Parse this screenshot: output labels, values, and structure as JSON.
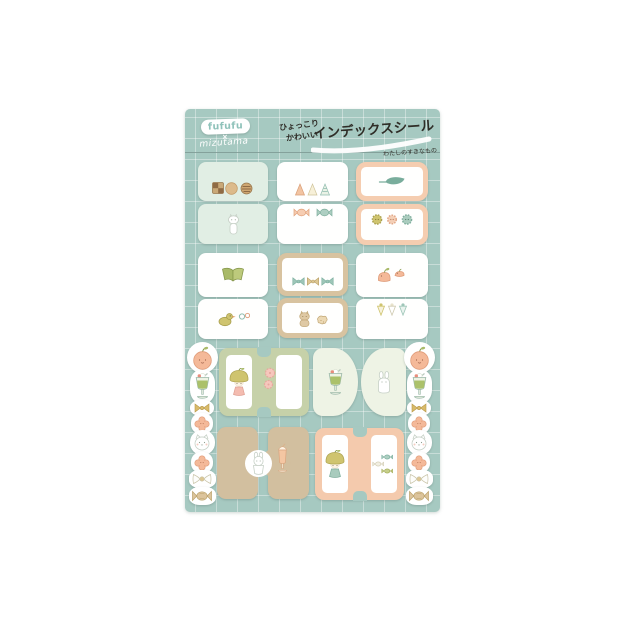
{
  "header": {
    "logo": "fufufu",
    "collab_mark": "×",
    "brand": "mizutama",
    "tagline_line1": "ひょっこり",
    "tagline_line2": "かわいい",
    "title": "インデックスシール",
    "subtitle": "わたしのすきなもの"
  },
  "palette": {
    "sheet": "#a6c9c1",
    "grid_line": "#cfe0da",
    "mint": "#e1eee4",
    "card_white": "#fffffe",
    "peach": "#f5cdb0",
    "tan": "#d8c3a0",
    "sage": "#c6d1a9",
    "mint_pale": "#eef3e5",
    "tan_solid": "#d2bf9f",
    "peach_h": "#f4caad",
    "logo_teal": "#8fc2ba",
    "ink": "#2f2d27",
    "cutline": "#7e9a94"
  },
  "stickers": {
    "tabs": [
      {
        "name": "snack-tab-mint",
        "type": "pair",
        "x": 198,
        "y": 162,
        "w": 70,
        "gap": 3,
        "halves": [
          {
            "h": 39,
            "style": "mint",
            "icon": "cookies",
            "pos": "bottom"
          },
          {
            "h": 40,
            "style": "mint",
            "icon": "cat-standing",
            "pos": "center"
          }
        ]
      },
      {
        "name": "hat-tab-white",
        "type": "pair",
        "x": 277,
        "y": 162,
        "w": 71,
        "gap": 3,
        "halves": [
          {
            "h": 39,
            "style": "white",
            "icon": "party-hats",
            "pos": "bottom"
          },
          {
            "h": 40,
            "style": "white",
            "icon": "candies",
            "pos": "top"
          }
        ]
      },
      {
        "name": "leaf-tab-peach",
        "type": "pair",
        "x": 356,
        "y": 162,
        "w": 72,
        "gap": 3,
        "halves": [
          {
            "h": 39,
            "style": "peach-frame",
            "icon": "leaf",
            "pos": "center"
          },
          {
            "h": 41,
            "style": "peach-frame",
            "icon": "buttons",
            "pos": "top"
          }
        ]
      },
      {
        "name": "book-tab-white",
        "type": "pair",
        "x": 198,
        "y": 253,
        "w": 70,
        "gap": 2,
        "halves": [
          {
            "h": 44,
            "style": "white",
            "icon": "book",
            "pos": "center"
          },
          {
            "h": 40,
            "style": "white",
            "icon": "duck-flowers",
            "pos": "center"
          }
        ]
      },
      {
        "name": "bow-tab-tan",
        "type": "pair",
        "x": 277,
        "y": 253,
        "w": 71,
        "gap": 2,
        "halves": [
          {
            "h": 43,
            "style": "tan-frame",
            "icon": "bows",
            "pos": "bottom"
          },
          {
            "h": 40,
            "style": "tan-frame",
            "icon": "cat-cookie",
            "pos": "center"
          }
        ]
      },
      {
        "name": "bird-tab-white",
        "type": "pair",
        "x": 356,
        "y": 253,
        "w": 72,
        "gap": 2,
        "halves": [
          {
            "h": 44,
            "style": "white",
            "icon": "birds",
            "pos": "center"
          },
          {
            "h": 40,
            "style": "white",
            "icon": "cones",
            "pos": "top"
          }
        ]
      },
      {
        "name": "girl-tab-sage",
        "type": "h",
        "x": 219,
        "y": 348,
        "w": 90,
        "h": 68,
        "color": "sage",
        "win_w": 26,
        "icon_left": "girl-pink",
        "icon_mid": "blossoms",
        "icon_right": null
      },
      {
        "name": "soda-tab-halfround",
        "type": "dd",
        "x": 313,
        "y": 348,
        "dw": 45,
        "h": 68,
        "gap": 3,
        "color": "mint_pale",
        "icon_left": "cream-soda",
        "icon_right": "rabbit"
      },
      {
        "name": "rabbit-tab-tan",
        "type": "circle",
        "x": 217,
        "y": 427,
        "h": 72,
        "color": "tan_solid",
        "icon_left": "rabbit-cup",
        "icon_right": "milkshake"
      },
      {
        "name": "girl-tab-peach",
        "type": "h",
        "x": 315,
        "y": 428,
        "w": 89,
        "h": 72,
        "color": "peach_h",
        "win_w": 26,
        "icon_left": "girl-teal",
        "icon_mid": null,
        "icon_right": "fish-candies"
      }
    ],
    "side": {
      "columns": [
        202,
        419
      ],
      "items": [
        {
          "icon": "apple",
          "y": 342,
          "w": 27,
          "h": 27,
          "round": "50%"
        },
        {
          "icon": "cream-soda",
          "y": 370,
          "w": 21,
          "h": 29,
          "round": "40%"
        },
        {
          "icon": "bow-gold",
          "y": 400,
          "w": 20,
          "h": 12,
          "round": "45%"
        },
        {
          "icon": "flower",
          "y": 413,
          "w": 18,
          "h": 17,
          "round": "45%"
        },
        {
          "icon": "cat-face",
          "y": 430,
          "w": 21,
          "h": 21,
          "round": "48%"
        },
        {
          "icon": "flower",
          "y": 452,
          "w": 18,
          "h": 17,
          "round": "45%"
        },
        {
          "icon": "bow-white",
          "y": 470,
          "w": 23,
          "h": 14,
          "round": "40%"
        },
        {
          "icon": "candy-tan",
          "y": 487,
          "w": 23,
          "h": 14,
          "round": "40%"
        }
      ]
    }
  }
}
